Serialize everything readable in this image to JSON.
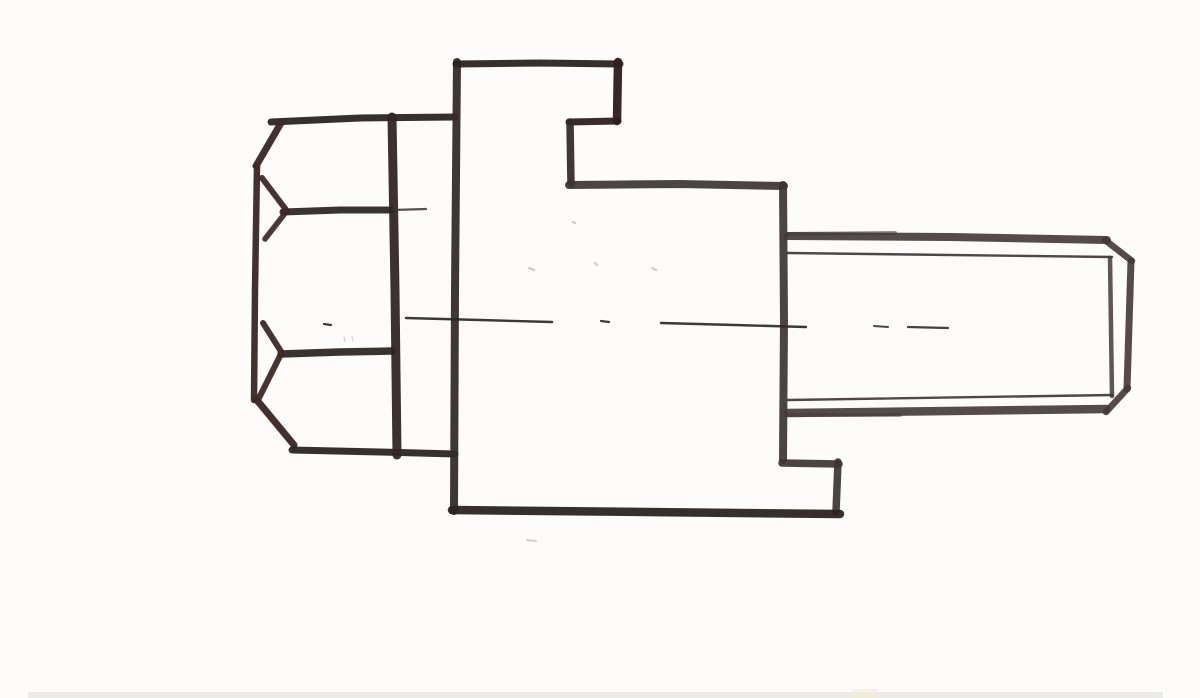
{
  "canvas": {
    "width": 1200,
    "height": 698,
    "background": "#fdfcfa"
  },
  "palette": {
    "ink_dark": "#2b2422",
    "ink_maroon": "#3c2828",
    "ink_edge": "#322527",
    "ink_body": "#352b2b",
    "ink_maroon_dark": "#301d20",
    "ink_gray": "#3d3335",
    "ink_shank": "#443739",
    "ink_thin": "#3a3335",
    "centerline": "#282828",
    "speck": "#8f8c86",
    "paper_edge": "#ebebe8",
    "paper_warm": "#f3ecd8"
  },
  "sketch": {
    "description": "Hand-drawn marker sketch of a hex-head bolt in side view: hexagonal head at left with chamfer arcs, stepped rectangular body in the middle, threaded shank with chamfered tip at right, dashed center axis line.",
    "parts": {
      "hex_head": "hex head, side view, two faces with chamfer arcs",
      "flange_body": "stepped body / flange block",
      "threaded_shank": "threaded shank, thin crest lines, chamfered end",
      "center_axis": "dashed horizontal center line"
    },
    "rects": [
      {
        "name": "paper-edge-shadow",
        "x": 28,
        "y": 692,
        "w": 1135,
        "h": 6,
        "color": "paper_edge",
        "opacity": 1
      },
      {
        "name": "paper-warm-spot",
        "x": 852,
        "y": 689,
        "w": 26,
        "h": 9,
        "color": "paper_warm",
        "opacity": 0.65
      }
    ],
    "strokes": [
      {
        "name": "head-top-edge",
        "part": "hex_head",
        "color": "ink_dark",
        "width": 7,
        "opacity": 0.95,
        "points": [
          [
            271,
            122
          ],
          [
            360,
            118
          ],
          [
            455,
            117
          ]
        ]
      },
      {
        "name": "head-top-chamfer",
        "part": "hex_head",
        "color": "ink_maroon",
        "width": 7,
        "opacity": 0.96,
        "points": [
          [
            281,
            123
          ],
          [
            256,
            166
          ]
        ]
      },
      {
        "name": "head-left-edge",
        "part": "hex_head",
        "color": "ink_maroon",
        "width": 6.5,
        "opacity": 0.96,
        "points": [
          [
            257,
            166
          ],
          [
            255,
            290
          ],
          [
            254,
            400
          ]
        ]
      },
      {
        "name": "head-bottom-chamfer",
        "part": "hex_head",
        "color": "ink_maroon",
        "width": 7,
        "opacity": 0.96,
        "points": [
          [
            256,
            399
          ],
          [
            294,
            445
          ]
        ]
      },
      {
        "name": "head-bottom-edge",
        "part": "hex_head",
        "color": "ink_dark",
        "width": 7,
        "opacity": 0.95,
        "points": [
          [
            292,
            450
          ],
          [
            380,
            452
          ],
          [
            455,
            454
          ]
        ]
      },
      {
        "name": "head-corner-edge",
        "part": "hex_head",
        "color": "ink_edge",
        "width": 9,
        "opacity": 0.95,
        "points": [
          [
            392,
            117
          ],
          [
            395,
            290
          ],
          [
            397,
            455
          ]
        ]
      },
      {
        "name": "head-face-line-upper",
        "part": "hex_head",
        "color": "ink_dark",
        "width": 7,
        "opacity": 0.93,
        "points": [
          [
            283,
            212
          ],
          [
            340,
            210
          ],
          [
            391,
            210
          ]
        ]
      },
      {
        "name": "head-face-line-upper-tick",
        "part": "hex_head",
        "color": "ink_thin",
        "width": 2.2,
        "opacity": 0.85,
        "points": [
          [
            392,
            210
          ],
          [
            426,
            209
          ]
        ]
      },
      {
        "name": "head-arc-upper-a",
        "part": "hex_head",
        "color": "ink_maroon",
        "width": 6,
        "opacity": 0.95,
        "points": [
          [
            262,
            178
          ],
          [
            287,
            211
          ]
        ]
      },
      {
        "name": "head-arc-upper-b",
        "part": "hex_head",
        "color": "ink_maroon",
        "width": 5.5,
        "opacity": 0.93,
        "points": [
          [
            286,
            212
          ],
          [
            265,
            239
          ]
        ]
      },
      {
        "name": "head-face-line-lower",
        "part": "hex_head",
        "color": "ink_dark",
        "width": 7.5,
        "opacity": 0.93,
        "points": [
          [
            281,
            354
          ],
          [
            340,
            352
          ],
          [
            392,
            351
          ]
        ]
      },
      {
        "name": "head-arc-lower-a",
        "part": "hex_head",
        "color": "ink_maroon",
        "width": 6,
        "opacity": 0.95,
        "points": [
          [
            263,
            323
          ],
          [
            282,
            353
          ]
        ]
      },
      {
        "name": "head-arc-lower-b",
        "part": "hex_head",
        "color": "ink_maroon",
        "width": 6,
        "opacity": 0.95,
        "points": [
          [
            280,
            356
          ],
          [
            259,
            398
          ]
        ]
      },
      {
        "name": "body-left-edge",
        "part": "flange_body",
        "color": "ink_body",
        "width": 8,
        "opacity": 0.95,
        "points": [
          [
            457,
            62
          ],
          [
            455,
            290
          ],
          [
            454,
            511
          ]
        ]
      },
      {
        "name": "body-top-edge",
        "part": "flange_body",
        "color": "ink_dark",
        "width": 7,
        "opacity": 0.95,
        "points": [
          [
            456,
            64
          ],
          [
            540,
            63
          ],
          [
            620,
            64
          ]
        ]
      },
      {
        "name": "body-upper-right-edge",
        "part": "flange_body",
        "color": "ink_maroon_dark",
        "width": 8.5,
        "opacity": 0.96,
        "points": [
          [
            618,
            62
          ],
          [
            617,
            121
          ]
        ]
      },
      {
        "name": "body-step-top",
        "part": "flange_body",
        "color": "ink_maroon_dark",
        "width": 7,
        "opacity": 0.94,
        "points": [
          [
            618,
            121
          ],
          [
            569,
            122
          ]
        ]
      },
      {
        "name": "body-step-edge",
        "part": "flange_body",
        "color": "ink_body",
        "width": 7.5,
        "opacity": 0.94,
        "points": [
          [
            570,
            122
          ],
          [
            571,
            184
          ]
        ]
      },
      {
        "name": "body-shoulder-edge",
        "part": "flange_body",
        "color": "ink_gray",
        "width": 8,
        "opacity": 0.92,
        "points": [
          [
            569,
            185
          ],
          [
            680,
            184
          ],
          [
            784,
            186
          ]
        ]
      },
      {
        "name": "body-right-edge",
        "part": "flange_body",
        "color": "ink_gray",
        "width": 8,
        "opacity": 0.92,
        "points": [
          [
            783,
            185
          ],
          [
            784,
            320
          ],
          [
            783,
            460
          ]
        ]
      },
      {
        "name": "body-foot-step-top",
        "part": "flange_body",
        "color": "ink_gray",
        "width": 7.5,
        "opacity": 0.92,
        "points": [
          [
            782,
            463
          ],
          [
            839,
            464
          ]
        ]
      },
      {
        "name": "body-foot-step-edge",
        "part": "flange_body",
        "color": "ink_gray",
        "width": 7.5,
        "opacity": 0.92,
        "points": [
          [
            838,
            462
          ],
          [
            836,
            512
          ]
        ]
      },
      {
        "name": "body-bottom-edge",
        "part": "flange_body",
        "color": "ink_dark",
        "width": 8.5,
        "opacity": 0.95,
        "points": [
          [
            840,
            514
          ],
          [
            645,
            512
          ],
          [
            452,
            510
          ]
        ]
      },
      {
        "name": "shank-top-edge",
        "part": "threaded_shank",
        "color": "ink_shank",
        "width": 8,
        "opacity": 0.9,
        "points": [
          [
            788,
            236
          ],
          [
            950,
            237
          ],
          [
            1107,
            240
          ]
        ]
      },
      {
        "name": "shank-top-edge-overlap",
        "part": "threaded_shank",
        "color": "ink_shank",
        "width": 4,
        "opacity": 0.55,
        "points": [
          [
            788,
            234
          ],
          [
            895,
            233
          ]
        ]
      },
      {
        "name": "shank-crest-line-top",
        "part": "threaded_shank",
        "color": "ink_thin",
        "width": 2.4,
        "opacity": 0.9,
        "points": [
          [
            788,
            253
          ],
          [
            1112,
            257
          ]
        ]
      },
      {
        "name": "shank-crest-line-bottom",
        "part": "threaded_shank",
        "color": "ink_thin",
        "width": 2.4,
        "opacity": 0.9,
        "points": [
          [
            788,
            400
          ],
          [
            1113,
            395
          ]
        ]
      },
      {
        "name": "shank-bottom-edge",
        "part": "threaded_shank",
        "color": "ink_shank",
        "width": 8.5,
        "opacity": 0.9,
        "points": [
          [
            788,
            413
          ],
          [
            950,
            411
          ],
          [
            1106,
            409
          ]
        ]
      },
      {
        "name": "shank-bottom-edge-overlap",
        "part": "threaded_shank",
        "color": "ink_shank",
        "width": 4,
        "opacity": 0.5,
        "points": [
          [
            788,
            415
          ],
          [
            900,
            415
          ]
        ]
      },
      {
        "name": "shank-chamfer-top",
        "part": "threaded_shank",
        "color": "ink_shank",
        "width": 6.5,
        "opacity": 0.9,
        "points": [
          [
            1105,
            240
          ],
          [
            1132,
            261
          ]
        ]
      },
      {
        "name": "shank-end-edge",
        "part": "threaded_shank",
        "color": "ink_shank",
        "width": 7,
        "opacity": 0.9,
        "points": [
          [
            1131,
            261
          ],
          [
            1127,
            389
          ]
        ]
      },
      {
        "name": "shank-chamfer-bottom",
        "part": "threaded_shank",
        "color": "ink_shank",
        "width": 6.5,
        "opacity": 0.9,
        "points": [
          [
            1128,
            388
          ],
          [
            1106,
            412
          ]
        ]
      },
      {
        "name": "shank-chamfer-root-edge",
        "part": "threaded_shank",
        "color": "ink_shank",
        "width": 4.5,
        "opacity": 0.85,
        "points": [
          [
            1110,
            258
          ],
          [
            1112,
            396
          ]
        ]
      },
      {
        "name": "axis-dot-1",
        "part": "center_axis",
        "color": "centerline",
        "width": 2.2,
        "opacity": 0.9,
        "points": [
          [
            324,
            324
          ],
          [
            331,
            325
          ]
        ]
      },
      {
        "name": "axis-dash-1",
        "part": "center_axis",
        "color": "centerline",
        "width": 2.4,
        "opacity": 0.92,
        "points": [
          [
            406,
            318
          ],
          [
            480,
            320
          ],
          [
            552,
            322
          ]
        ]
      },
      {
        "name": "axis-dot-2",
        "part": "center_axis",
        "color": "centerline",
        "width": 2.2,
        "opacity": 0.9,
        "points": [
          [
            601,
            321
          ],
          [
            609,
            322
          ]
        ]
      },
      {
        "name": "axis-dash-2",
        "part": "center_axis",
        "color": "centerline",
        "width": 2.4,
        "opacity": 0.92,
        "points": [
          [
            661,
            323
          ],
          [
            735,
            325
          ],
          [
            806,
            327
          ]
        ]
      },
      {
        "name": "axis-dash-3",
        "part": "center_axis",
        "color": "centerline",
        "width": 2,
        "opacity": 0.85,
        "points": [
          [
            874,
            326
          ],
          [
            888,
            327
          ]
        ]
      },
      {
        "name": "axis-dash-4",
        "part": "center_axis",
        "color": "centerline",
        "width": 2.2,
        "opacity": 0.88,
        "points": [
          [
            908,
            327
          ],
          [
            948,
            328
          ]
        ]
      },
      {
        "name": "paper-speck-1",
        "part": "paper",
        "color": "speck",
        "width": 2,
        "opacity": 0.5,
        "points": [
          [
            529,
            268
          ],
          [
            534,
            270
          ]
        ]
      },
      {
        "name": "paper-speck-2",
        "part": "paper",
        "color": "speck",
        "width": 2,
        "opacity": 0.45,
        "points": [
          [
            652,
            268
          ],
          [
            656,
            270
          ]
        ]
      },
      {
        "name": "paper-speck-3",
        "part": "paper",
        "color": "speck",
        "width": 2,
        "opacity": 0.5,
        "points": [
          [
            573,
            222
          ],
          [
            575,
            223
          ]
        ]
      },
      {
        "name": "paper-speck-4",
        "part": "paper",
        "color": "speck",
        "width": 2,
        "opacity": 0.45,
        "points": [
          [
            595,
            263
          ],
          [
            597,
            265
          ]
        ]
      },
      {
        "name": "paper-speck-5",
        "part": "paper",
        "color": "speck",
        "width": 1.5,
        "opacity": 0.35,
        "points": [
          [
            344,
            337
          ],
          [
            345,
            341
          ]
        ]
      },
      {
        "name": "paper-speck-6",
        "part": "paper",
        "color": "speck",
        "width": 1.5,
        "opacity": 0.3,
        "points": [
          [
            352,
            337
          ],
          [
            353,
            341
          ]
        ]
      },
      {
        "name": "paper-speck-7",
        "part": "paper",
        "color": "speck",
        "width": 2,
        "opacity": 0.4,
        "points": [
          [
            527,
            540
          ],
          [
            536,
            541
          ]
        ]
      }
    ]
  }
}
